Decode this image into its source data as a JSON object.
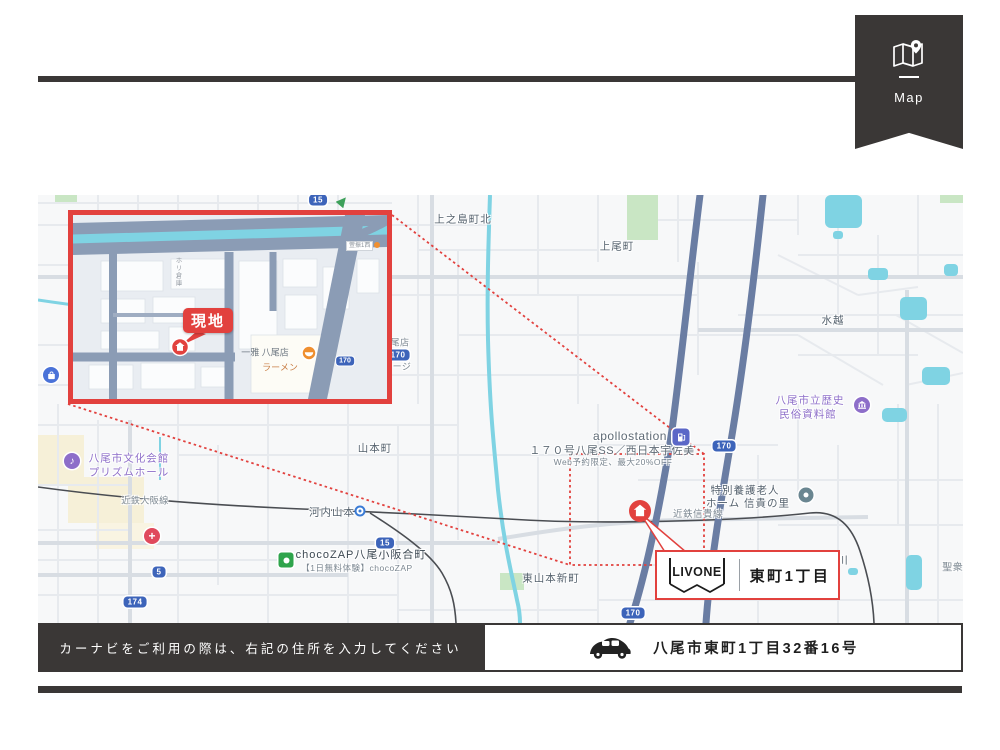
{
  "badge": {
    "label": "Map"
  },
  "map": {
    "labels": {
      "kaminoshima": "上之島町北",
      "kamio": "上尾町",
      "mizukoshi": "水越",
      "yamamoto": "山本町",
      "kawachiyamamoto": "河内山本",
      "bunka1": "八尾市文化会館",
      "bunka2": "プリズムホール",
      "osakaline": "近鉄大阪線",
      "chocozap": "chocoZAP八尾小阪合町",
      "chocozap_sub": "【1日無料体験】chocoZAP",
      "higashiyamamoto": "東山本新町",
      "shigiline": "近鉄信貴線",
      "gas_name": "apollostation",
      "gas_branch": "１７０号八尾SS／西日本宇佐美",
      "gas_promo": "Web予約限定、最大20%OFF",
      "elderly1": "特別養護老人",
      "elderly2": "ホーム 信貴の里",
      "museum1": "八尾市立歴史",
      "museum2": "民俗資料館",
      "kawa": "川",
      "shoju": "聖衆山",
      "partial_shop": "尾店",
      "partial_garage": "ージ"
    },
    "shields": {
      "top15": "15",
      "right170": "170",
      "lower170": "170",
      "mid15": "15",
      "edge170": "170",
      "r5": "5",
      "r174": "174"
    },
    "inset": {
      "site": "現地",
      "shop_name": "一雅 八尾店",
      "shop_sub": "ラーメン",
      "sign": "萱振1西",
      "vertical": "ホリ倉庫",
      "shield170": "170"
    },
    "callout": {
      "brand": "LIVONE",
      "area": "東町1丁目"
    }
  },
  "navi": {
    "message": "カーナビをご利用の際は、右記の住所を入力してください"
  },
  "address": {
    "value": "八尾市東町1丁目32番16号"
  },
  "colors": {
    "accent": "#e2413e",
    "dark": "#3a3736",
    "road_blue": "#6a7da3",
    "water": "#7fd3e3",
    "shield": "#3d64ba"
  }
}
